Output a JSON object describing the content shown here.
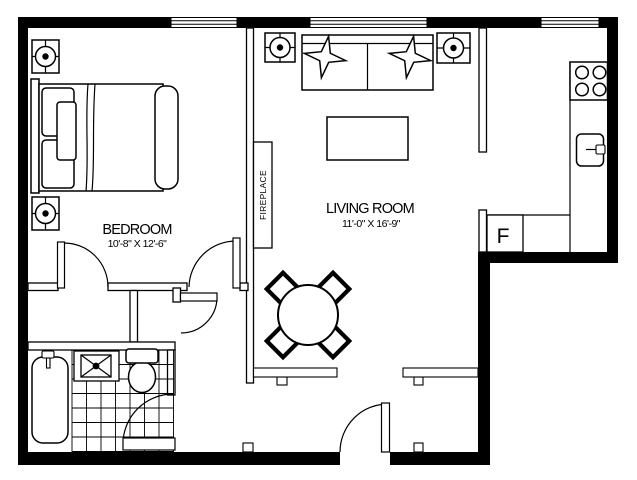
{
  "plan": {
    "rooms": {
      "bedroom": {
        "name": "BEDROOM",
        "dimensions": "10'-8\" X 12'-6\""
      },
      "living_room": {
        "name": "LIVING ROOM",
        "dimensions": "11'-0\" X 16'-9\""
      }
    },
    "labels": {
      "fireplace": "FIREPLACE",
      "refrigerator": "F"
    },
    "colors": {
      "wall": "#000000",
      "line": "#1a1a1a",
      "background": "#ffffff"
    },
    "fixtures": {
      "ceiling_lights": 4,
      "windows": 3,
      "door_swings": 5,
      "furniture": [
        "bed",
        "sofa",
        "coffee-table",
        "dining-table",
        "dining-chairs",
        "fireplace",
        "stove",
        "kitchen-sink",
        "refrigerator",
        "bathtub",
        "vanity-sink",
        "toilet",
        "bathroom-tile-floor",
        "baseboard-heaters"
      ]
    }
  }
}
